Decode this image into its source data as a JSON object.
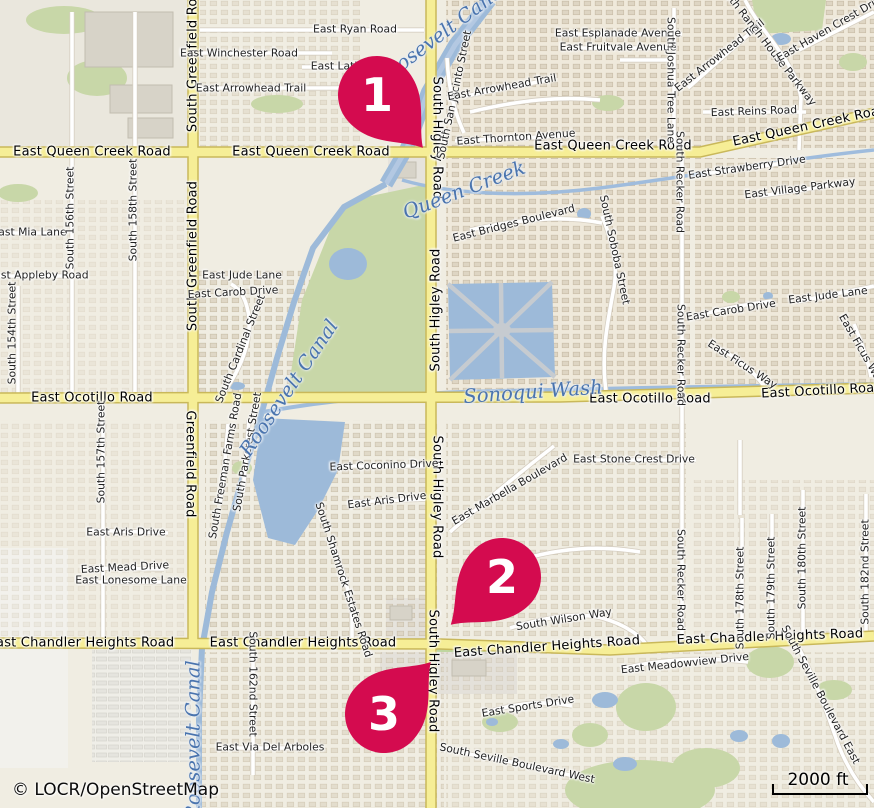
{
  "map": {
    "attribution": "© LOCR/OpenStreetMap",
    "scale": {
      "label": "2000 ft"
    },
    "colors": {
      "marker": "#D40B4F",
      "marker_text": "#FFFFFF",
      "major_road": "#F6EE96",
      "major_road_casing": "#C9B85A",
      "water": "#9DBAD9",
      "green": "#C8D7A8",
      "land": "#F0EDE2"
    },
    "markers": [
      {
        "number": "1",
        "x": 377,
        "y": 95,
        "angle": -41
      },
      {
        "number": "2",
        "x": 502,
        "y": 577,
        "angle": 47
      },
      {
        "number": "3",
        "x": 384,
        "y": 714,
        "angle": -138
      }
    ],
    "labels": [
      {
        "t": "East Queen Creek Road",
        "x": 92,
        "y": 152,
        "r": 0,
        "k": "mj"
      },
      {
        "t": "East Queen Creek Road",
        "x": 311,
        "y": 152,
        "r": 0,
        "k": "mj"
      },
      {
        "t": "East Queen Creek Road",
        "x": 613,
        "y": 146,
        "r": 0,
        "k": "mj"
      },
      {
        "t": "East Queen Creek Road",
        "x": 810,
        "y": 126,
        "r": -12,
        "k": "mj"
      },
      {
        "t": "East Ocotillo Road",
        "x": 92,
        "y": 398,
        "r": 0,
        "k": "mj"
      },
      {
        "t": "East Ocotillo Road",
        "x": 650,
        "y": 399,
        "r": 0,
        "k": "mj"
      },
      {
        "t": "East Ocotillo Road",
        "x": 822,
        "y": 391,
        "r": -3,
        "k": "mj"
      },
      {
        "t": "East Chandler Heights Road",
        "x": 81,
        "y": 643,
        "r": 0,
        "k": "mj"
      },
      {
        "t": "East Chandler Heights Road",
        "x": 303,
        "y": 643,
        "r": 0,
        "k": "mj"
      },
      {
        "t": "East Chandler Heights Road",
        "x": 547,
        "y": 647,
        "r": -4,
        "k": "mj"
      },
      {
        "t": "East Chandler Heights Road",
        "x": 770,
        "y": 637,
        "r": -2,
        "k": "mj"
      },
      {
        "t": "South Greenfield Road",
        "x": 193,
        "y": 57,
        "r": -90,
        "k": "mj"
      },
      {
        "t": "South Greenfield Road",
        "x": 193,
        "y": 256,
        "r": -90,
        "k": "mj"
      },
      {
        "t": "Greenfield Road",
        "x": 190,
        "y": 464,
        "r": 90,
        "k": "mj"
      },
      {
        "t": "South Higley Road",
        "x": 437,
        "y": 138,
        "r": 90,
        "k": "mj"
      },
      {
        "t": "South Higley Road",
        "x": 436,
        "y": 310,
        "r": -90,
        "k": "mj"
      },
      {
        "t": "South Higley Road",
        "x": 437,
        "y": 497,
        "r": 90,
        "k": "mj"
      },
      {
        "t": "South Higley Road",
        "x": 433,
        "y": 671,
        "r": 90,
        "k": "mj"
      },
      {
        "t": "East Ryan Road",
        "x": 355,
        "y": 30,
        "r": 0,
        "k": "mn"
      },
      {
        "t": "East Winchester Road",
        "x": 239,
        "y": 54,
        "r": 0,
        "k": "mn"
      },
      {
        "t": "East Lath",
        "x": 336,
        "y": 67,
        "r": 0,
        "k": "mn"
      },
      {
        "t": "East Arrowhead Trail",
        "x": 251,
        "y": 89,
        "r": 0,
        "k": "mn"
      },
      {
        "t": "East Esplanade Avenue",
        "x": 618,
        "y": 34,
        "r": 0,
        "k": "mn"
      },
      {
        "t": "East Fruitvale Avenue",
        "x": 618,
        "y": 48,
        "r": 0,
        "k": "mn"
      },
      {
        "t": "South San Jacinto Street",
        "x": 455,
        "y": 95,
        "r": -78,
        "k": "mn"
      },
      {
        "t": "East Arrowhead Trail",
        "x": 502,
        "y": 88,
        "r": -10,
        "k": "mn"
      },
      {
        "t": "South Joshua Tree Lane",
        "x": 670,
        "y": 80,
        "r": 90,
        "k": "mn"
      },
      {
        "t": "East Arrowhead Trail",
        "x": 720,
        "y": 56,
        "r": -38,
        "k": "mn"
      },
      {
        "t": "South Ranch House Parkway",
        "x": 766,
        "y": 44,
        "r": 52,
        "k": "mn"
      },
      {
        "t": "East Haven Crest Drive",
        "x": 832,
        "y": 28,
        "r": -30,
        "k": "mn"
      },
      {
        "t": "East Reins Road",
        "x": 754,
        "y": 112,
        "r": -2,
        "k": "mn"
      },
      {
        "t": "East Thornton Avenue",
        "x": 516,
        "y": 138,
        "r": -4,
        "k": "mn"
      },
      {
        "t": "East Strawberry Drive",
        "x": 747,
        "y": 168,
        "r": -8,
        "k": "mn"
      },
      {
        "t": "East Village Parkway",
        "x": 800,
        "y": 189,
        "r": -7,
        "k": "mn"
      },
      {
        "t": "South Recker Road",
        "x": 679,
        "y": 182,
        "r": 90,
        "k": "mn"
      },
      {
        "t": "East Mia Lane",
        "x": 29,
        "y": 233,
        "r": 0,
        "k": "mn"
      },
      {
        "t": "South 156th Street",
        "x": 71,
        "y": 218,
        "r": -90,
        "k": "mn"
      },
      {
        "t": "South 158th Street",
        "x": 134,
        "y": 210,
        "r": -90,
        "k": "mn"
      },
      {
        "t": "East Appleby Road",
        "x": 38,
        "y": 276,
        "r": 0,
        "k": "mn"
      },
      {
        "t": "South 154th Street",
        "x": 13,
        "y": 333,
        "r": -90,
        "k": "mn"
      },
      {
        "t": "East Jude Lane",
        "x": 242,
        "y": 276,
        "r": 0,
        "k": "mn"
      },
      {
        "t": "East Carob Drive",
        "x": 233,
        "y": 293,
        "r": -3,
        "k": "mn"
      },
      {
        "t": "South Cardinal Street",
        "x": 241,
        "y": 349,
        "r": -68,
        "k": "mn"
      },
      {
        "t": "East Bridges Boulevard",
        "x": 514,
        "y": 224,
        "r": -14,
        "k": "mn"
      },
      {
        "t": "South Soboba Street",
        "x": 614,
        "y": 250,
        "r": 78,
        "k": "mn"
      },
      {
        "t": "South Recker Road",
        "x": 680,
        "y": 355,
        "r": 90,
        "k": "mn"
      },
      {
        "t": "East Carob Drive",
        "x": 731,
        "y": 311,
        "r": -9,
        "k": "mn"
      },
      {
        "t": "East Jude Lane",
        "x": 828,
        "y": 296,
        "r": -7,
        "k": "mn"
      },
      {
        "t": "East Ficus Way",
        "x": 742,
        "y": 365,
        "r": 33,
        "k": "mn"
      },
      {
        "t": "East Ficus Way",
        "x": 861,
        "y": 350,
        "r": 60,
        "k": "mn"
      },
      {
        "t": "South 157th Street",
        "x": 102,
        "y": 452,
        "r": -90,
        "k": "mn"
      },
      {
        "t": "South Freeman Farms Road",
        "x": 226,
        "y": 466,
        "r": -80,
        "k": "mn"
      },
      {
        "t": "South Parkcrest Street",
        "x": 248,
        "y": 452,
        "r": -80,
        "k": "mn"
      },
      {
        "t": "East Coconino Drive",
        "x": 384,
        "y": 466,
        "r": -2,
        "k": "mn"
      },
      {
        "t": "East Aris Drive",
        "x": 387,
        "y": 501,
        "r": -7,
        "k": "mn"
      },
      {
        "t": "East Aris Drive",
        "x": 126,
        "y": 533,
        "r": 0,
        "k": "mn"
      },
      {
        "t": "East Mead Drive",
        "x": 125,
        "y": 568,
        "r": -3,
        "k": "mn"
      },
      {
        "t": "East Lonesome Lane",
        "x": 131,
        "y": 581,
        "r": 0,
        "k": "mn"
      },
      {
        "t": "South Shamrock Estates Road",
        "x": 343,
        "y": 580,
        "r": 72,
        "k": "mn"
      },
      {
        "t": "East Stone Crest Drive",
        "x": 634,
        "y": 460,
        "r": 0,
        "k": "mn"
      },
      {
        "t": "East Marbella Boulevard",
        "x": 510,
        "y": 490,
        "r": -30,
        "k": "mn"
      },
      {
        "t": "South Wilson Way",
        "x": 564,
        "y": 620,
        "r": -9,
        "k": "mn"
      },
      {
        "t": "South Recker Road",
        "x": 680,
        "y": 580,
        "r": 90,
        "k": "mn"
      },
      {
        "t": "South 178th Street",
        "x": 741,
        "y": 598,
        "r": -90,
        "k": "mn"
      },
      {
        "t": "South 179th Street",
        "x": 772,
        "y": 588,
        "r": -90,
        "k": "mn"
      },
      {
        "t": "South 180th Street",
        "x": 803,
        "y": 558,
        "r": -90,
        "k": "mn"
      },
      {
        "t": "South 182nd Street",
        "x": 866,
        "y": 572,
        "r": -90,
        "k": "mn"
      },
      {
        "t": "South 162nd Street",
        "x": 252,
        "y": 684,
        "r": 90,
        "k": "mn"
      },
      {
        "t": "East Via Del Arboles",
        "x": 270,
        "y": 748,
        "r": 0,
        "k": "mn"
      },
      {
        "t": "East Meadowview Drive",
        "x": 685,
        "y": 664,
        "r": -6,
        "k": "mn"
      },
      {
        "t": "South Seville Boulevard East",
        "x": 820,
        "y": 695,
        "r": 62,
        "k": "mn"
      },
      {
        "t": "East Sports Drive",
        "x": 528,
        "y": 707,
        "r": -9,
        "k": "mn"
      },
      {
        "t": "South Seville Boulevard West",
        "x": 517,
        "y": 764,
        "r": 12,
        "k": "mn"
      },
      {
        "t": "Roosevelt Canal",
        "x": 441,
        "y": 34,
        "r": -37,
        "k": "w"
      },
      {
        "t": "Roosevelt Canal",
        "x": 289,
        "y": 388,
        "r": -56,
        "k": "w"
      },
      {
        "t": "Roosevelt Canal",
        "x": 193,
        "y": 740,
        "r": -90,
        "k": "w"
      },
      {
        "t": "Queen Creek",
        "x": 464,
        "y": 190,
        "r": -21,
        "k": "w"
      },
      {
        "t": "Sonoqui Wash",
        "x": 533,
        "y": 392,
        "r": -4,
        "k": "w"
      }
    ]
  }
}
